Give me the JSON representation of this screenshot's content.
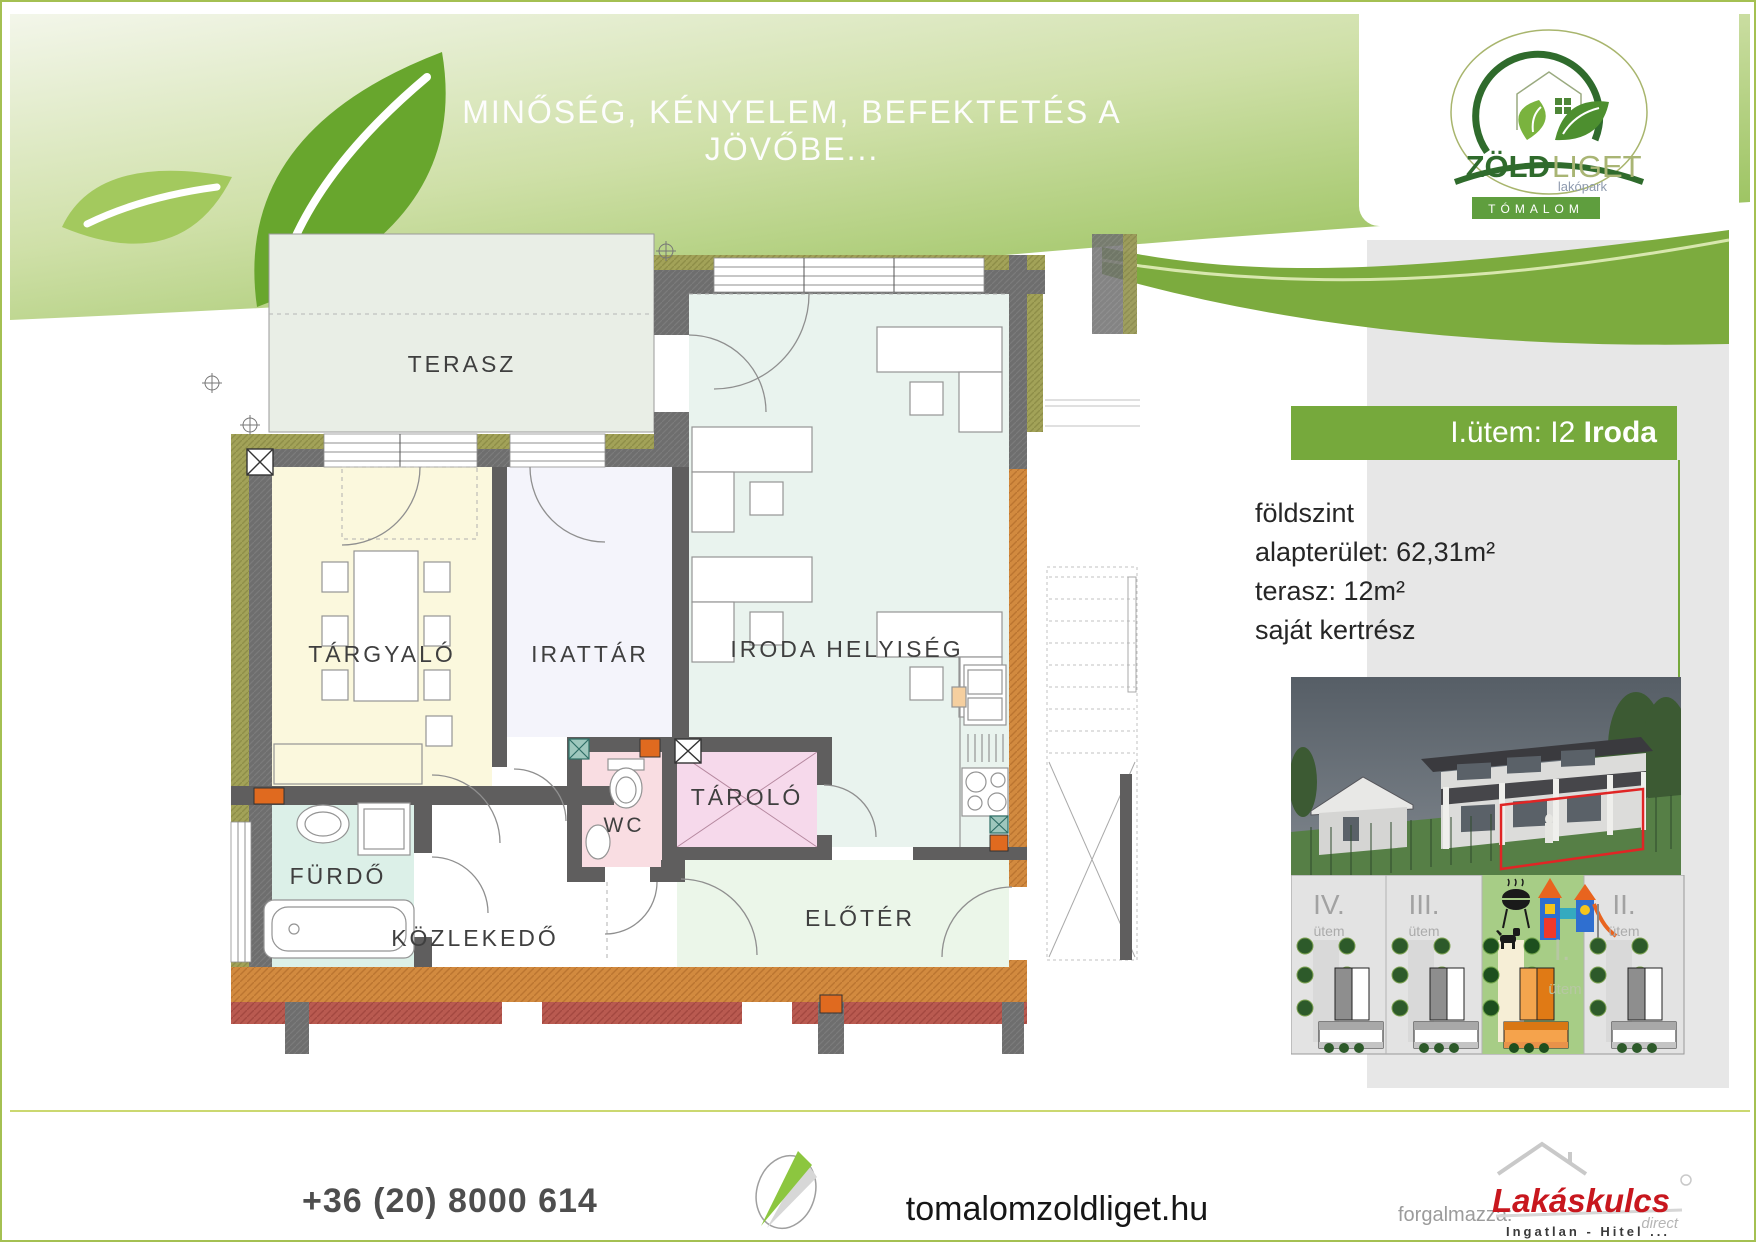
{
  "header": {
    "slogan": "MINŐSÉG, KÉNYELEM, BEFEKTETÉS A JÖVŐBE..."
  },
  "logo": {
    "zold": "ZÖLD",
    "liget": "LIGET",
    "sub": "lakópark",
    "band": "TÓMALOM"
  },
  "sidebar": {
    "banner_prefix": "I.ütem: I2 ",
    "banner_bold": "Iroda",
    "details": [
      "földszint",
      "alapterület: 62,31m²",
      "terasz: 12m²",
      "saját kertrész"
    ]
  },
  "plan": {
    "rooms": {
      "terasz": "TERASZ",
      "targyalo": "TÁRGYALÓ",
      "irattar": "IRATTÁR",
      "iroda": "IRODA HELYISÉG",
      "wc": "WC",
      "tarolo": "TÁROLÓ",
      "furdo": "FÜRDŐ",
      "kozlekedo": "KÖZLEKEDŐ",
      "eloter": "ELŐTÉR"
    }
  },
  "map": {
    "phase4": "IV.",
    "phase3": "III.",
    "phase1": "I.",
    "phase2": "II.",
    "utem": "ütem"
  },
  "footer": {
    "phone": "+36 (20) 8000 614",
    "website": "tomalomzoldliget.hu",
    "distributor_label": "forgalmazza:",
    "brand": "Lakáskulcs",
    "brand_sub": "direct",
    "brand_tagline": "Ingatlan - Hitel ..."
  },
  "colors": {
    "accent_green": "#76a93c",
    "header_green": "#8cba4a",
    "olive_wall": "#a2a258",
    "grey_wall": "#6b6b6b",
    "orange_wall": "#d28a3f",
    "highlight_orange": "#e8872e",
    "map_green": "#a7cd86",
    "brand_red": "#c8171e"
  }
}
